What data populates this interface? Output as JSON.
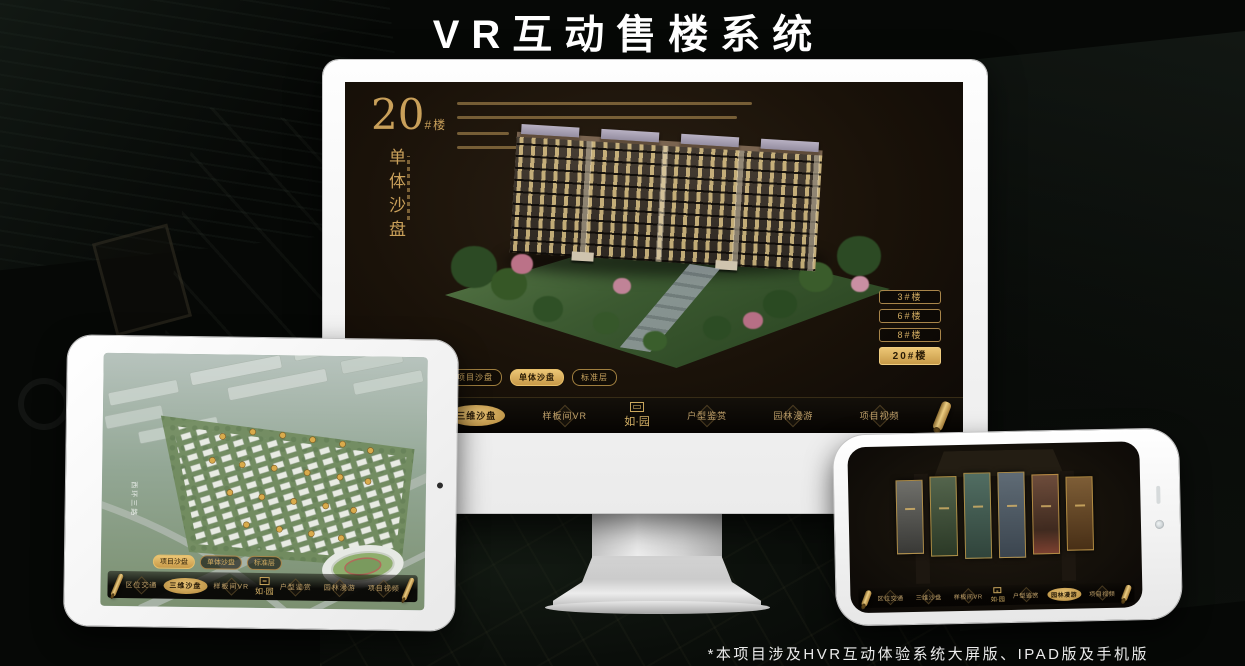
{
  "page": {
    "title": "VR互动售楼系统",
    "footnote": "*本项目涉及HVR互动体验系统大屏版、IPAD版及手机版"
  },
  "logo": {
    "text": "如·园"
  },
  "colors": {
    "gold": "#c9a05a",
    "gold_bright": "#e8c376",
    "screen_bg": "#1a1209"
  },
  "monitor": {
    "heading": {
      "number": "20",
      "suffix": "#楼",
      "title_vertical": "单体沙盘"
    },
    "floor_buttons": [
      {
        "label": "3#楼",
        "active": false
      },
      {
        "label": "6#楼",
        "active": false
      },
      {
        "label": "8#楼",
        "active": false
      },
      {
        "label": "20#楼",
        "active": true
      }
    ],
    "view_tabs": [
      {
        "label": "项目沙盘",
        "active": false
      },
      {
        "label": "单体沙盘",
        "active": true
      },
      {
        "label": "标准层",
        "active": false
      }
    ],
    "nav": {
      "items_left": [
        {
          "label": "区位交通",
          "active": false
        },
        {
          "label": "三维沙盘",
          "active": true
        },
        {
          "label": "样板间VR",
          "active": false
        }
      ],
      "items_right": [
        {
          "label": "户型鉴赏",
          "active": false
        },
        {
          "label": "园林漫游",
          "active": false
        },
        {
          "label": "项目视频",
          "active": false
        }
      ]
    }
  },
  "tablet": {
    "road_label": "西环三路",
    "view_tabs": [
      {
        "label": "项目沙盘",
        "active": true
      },
      {
        "label": "单体沙盘",
        "active": false
      },
      {
        "label": "标准层",
        "active": false
      }
    ],
    "nav": {
      "items_left": [
        {
          "label": "区位交通",
          "active": false
        },
        {
          "label": "三维沙盘",
          "active": true
        },
        {
          "label": "样板间VR",
          "active": false
        }
      ],
      "items_right": [
        {
          "label": "户型鉴赏",
          "active": false
        },
        {
          "label": "园林漫游",
          "active": false
        },
        {
          "label": "项目视频",
          "active": false
        }
      ]
    }
  },
  "phone": {
    "gallery_card_count": 6,
    "nav": {
      "items_left": [
        {
          "label": "区位交通",
          "active": false
        },
        {
          "label": "三维沙盘",
          "active": false
        },
        {
          "label": "样板间VR",
          "active": false
        }
      ],
      "items_right": [
        {
          "label": "户型鉴赏",
          "active": false
        },
        {
          "label": "园林漫游",
          "active": true
        },
        {
          "label": "项目视频",
          "active": false
        }
      ]
    }
  }
}
